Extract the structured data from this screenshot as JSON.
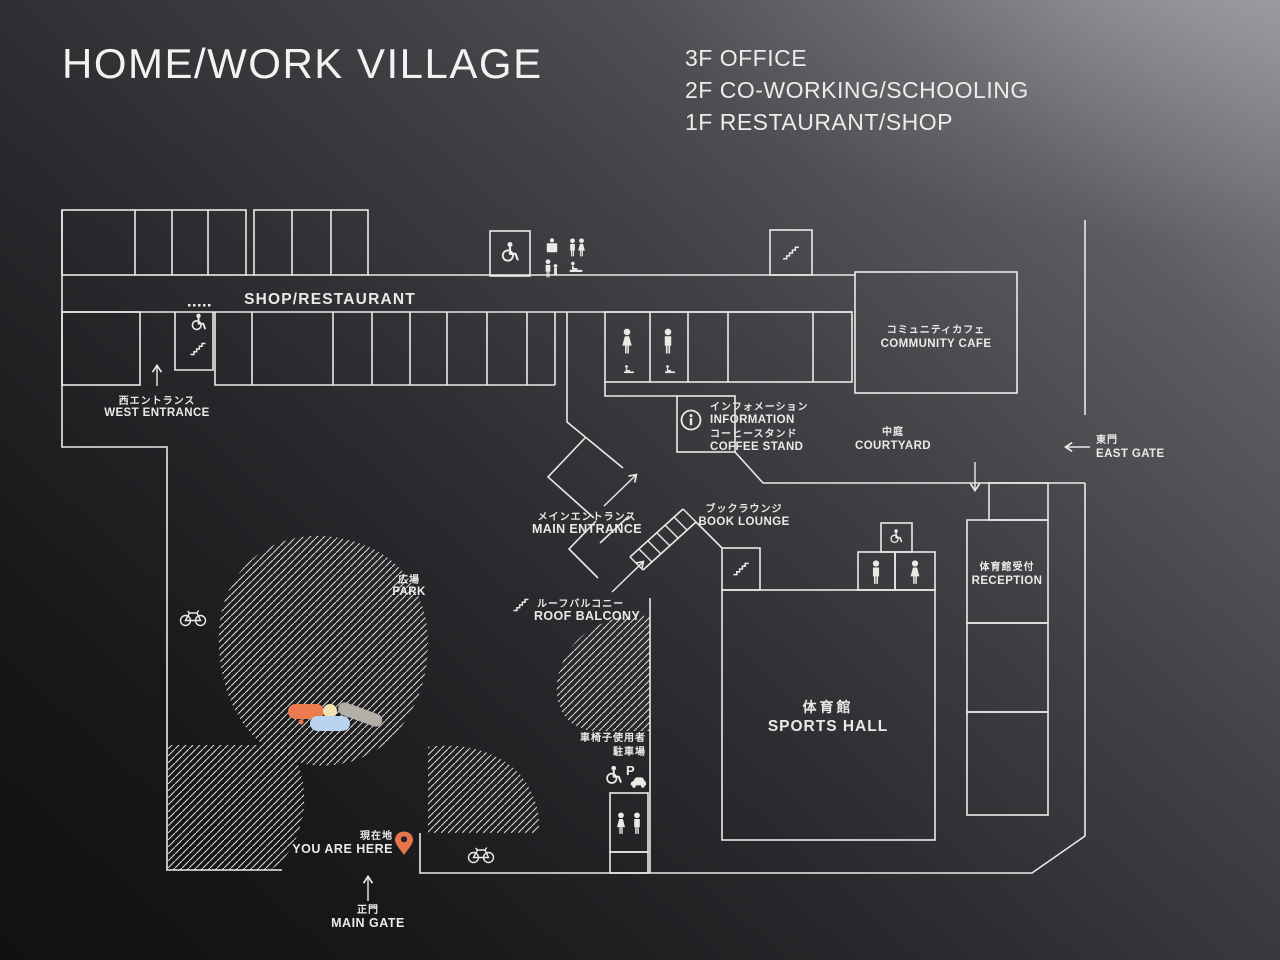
{
  "sign": {
    "title": "HOME/WORK VILLAGE",
    "floors": [
      "3F OFFICE",
      "2F CO-WORKING/SCHOOLING",
      "1F RESTAURANT/SHOP"
    ]
  },
  "map": {
    "shop_restaurant": "SHOP/RESTAURANT",
    "west_entrance": {
      "jp": "西エントランス",
      "en": "WEST ENTRANCE"
    },
    "information": {
      "jp": "インフォメーション",
      "en": "INFORMATION"
    },
    "coffee_stand": {
      "jp": "コーヒースタンド",
      "en": "COFFEE STAND"
    },
    "community_cafe": {
      "jp": "コミュニティカフェ",
      "en": "COMMUNITY CAFE"
    },
    "courtyard": {
      "jp": "中庭",
      "en": "COURTYARD"
    },
    "east_gate": {
      "jp": "東門",
      "en": "EAST GATE"
    },
    "main_entrance": {
      "jp": "メインエントランス",
      "en": "MAIN ENTRANCE"
    },
    "book_lounge": {
      "jp": "ブックラウンジ",
      "en": "BOOK LOUNGE"
    },
    "roof_balcony": {
      "jp": "ルーフバルコニー",
      "en": "ROOF BALCONY"
    },
    "park": {
      "jp": "広場",
      "en": "PARK"
    },
    "sports_hall": {
      "jp": "体育館",
      "en": "SPORTS HALL"
    },
    "reception": {
      "jp": "体育館受付",
      "en": "RECEPTION"
    },
    "accessible_parking": {
      "line1": "車椅子使用者",
      "line2": "駐車場"
    },
    "parking_letter": "P",
    "you_are_here": {
      "jp": "現在地",
      "en": "YOU ARE HERE"
    },
    "main_gate": {
      "jp": "正門",
      "en": "MAIN GATE"
    },
    "colors": {
      "line": "#ECEAE6",
      "accent": "#E8744C",
      "play_orange": "#EE7B50",
      "play_yellow": "#EFE3B4",
      "play_gray": "#B3AEA6",
      "play_blue": "#BAD4F0"
    }
  }
}
